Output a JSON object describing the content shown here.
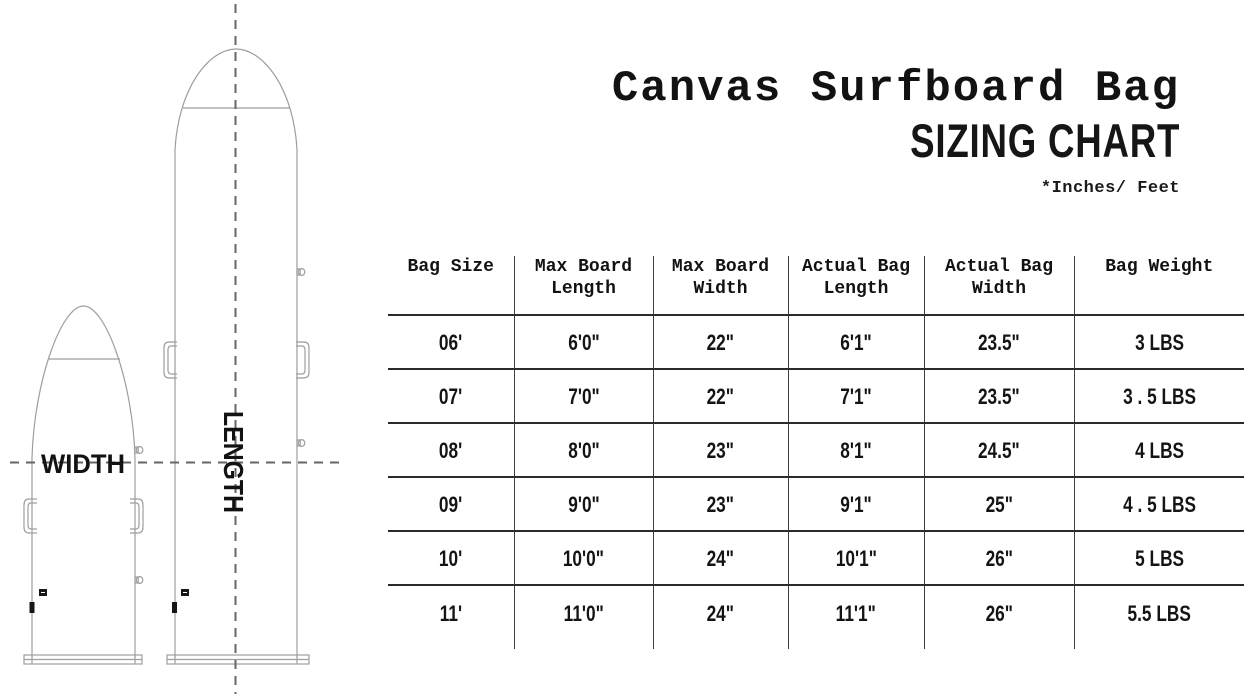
{
  "title": {
    "line1": "Canvas Surfboard Bag",
    "line2": "SIZING CHART",
    "note": "*Inches/ Feet"
  },
  "diagram": {
    "width_label": "WIDTH",
    "length_label": "LENGTH"
  },
  "table": {
    "header_lines": [
      [
        "Bag Size",
        ""
      ],
      [
        "Max Board",
        "Length"
      ],
      [
        "Max Board",
        "Width"
      ],
      [
        "Actual Bag",
        "Length"
      ],
      [
        "Actual Bag",
        "Width"
      ],
      [
        "Bag Weight",
        ""
      ]
    ]
  },
  "chart_data": {
    "type": "table",
    "title": "Canvas Surfboard Bag Sizing Chart",
    "units_note": "*Inches/ Feet",
    "columns": [
      "Bag Size",
      "Max Board Length",
      "Max Board Width",
      "Actual Bag Length",
      "Actual Bag Width",
      "Bag Weight"
    ],
    "rows": [
      [
        "06'",
        "6'0\"",
        "22\"",
        "6'1\"",
        "23.5\"",
        "3 LBS"
      ],
      [
        "07'",
        "7'0\"",
        "22\"",
        "7'1\"",
        "23.5\"",
        "3 . 5 LBS"
      ],
      [
        "08'",
        "8'0\"",
        "23\"",
        "8'1\"",
        "24.5\"",
        "4 LBS"
      ],
      [
        "09'",
        "9'0\"",
        "23\"",
        "9'1\"",
        "25\"",
        "4 . 5 LBS"
      ],
      [
        "10'",
        "10'0\"",
        "24\"",
        "10'1\"",
        "26\"",
        "5 LBS"
      ],
      [
        "11'",
        "11'0\"",
        "24\"",
        "11'1\"",
        "26\"",
        "5.5 LBS"
      ]
    ]
  },
  "colors": {
    "text": "#121212",
    "table_rule_dark": "#2b2b2b",
    "table_rule_vertical": "#3d3d3d",
    "outline_gray": "#9e9e9e",
    "dash_gray": "#666666",
    "background": "#ffffff"
  }
}
